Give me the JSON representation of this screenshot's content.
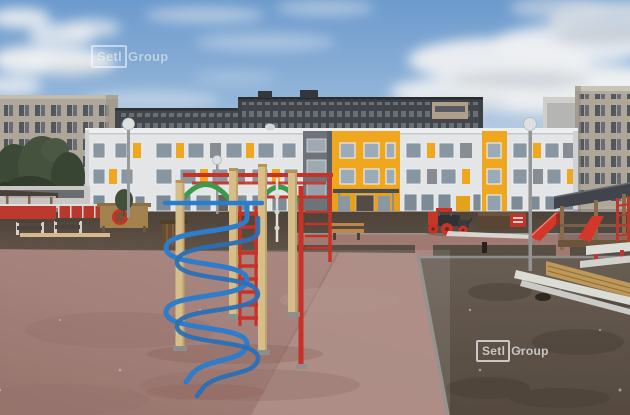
{
  "scene": {
    "description": "Construction-progress photo: new kindergarten courtyard with colorful climbing frames, play equipment and fresh landscaping in front of white-and-yellow low-rise building and taller apartment blocks under a partly cloudy sky",
    "location_type": "residential courtyard playground"
  },
  "watermark": {
    "brand_boxed": "Setl",
    "brand_suffix": "Group"
  },
  "palette": {
    "sky_blue": "#6f9ed2",
    "cloud_white": "#f3f5f7",
    "facade_white": "#e8eaeb",
    "facade_yellow": "#f3ab1f",
    "office_beige": "#b2aa9c",
    "office_dark_gray": "#45484d",
    "gym_red": "#cf3227",
    "gym_blue": "#2b7fd4",
    "gym_green": "#3f9e4f",
    "gym_wood": "#dcc28c",
    "rubber_pink": "#b5837c",
    "paver_pink": "#c79d94",
    "soil_brown": "#6e6054"
  }
}
